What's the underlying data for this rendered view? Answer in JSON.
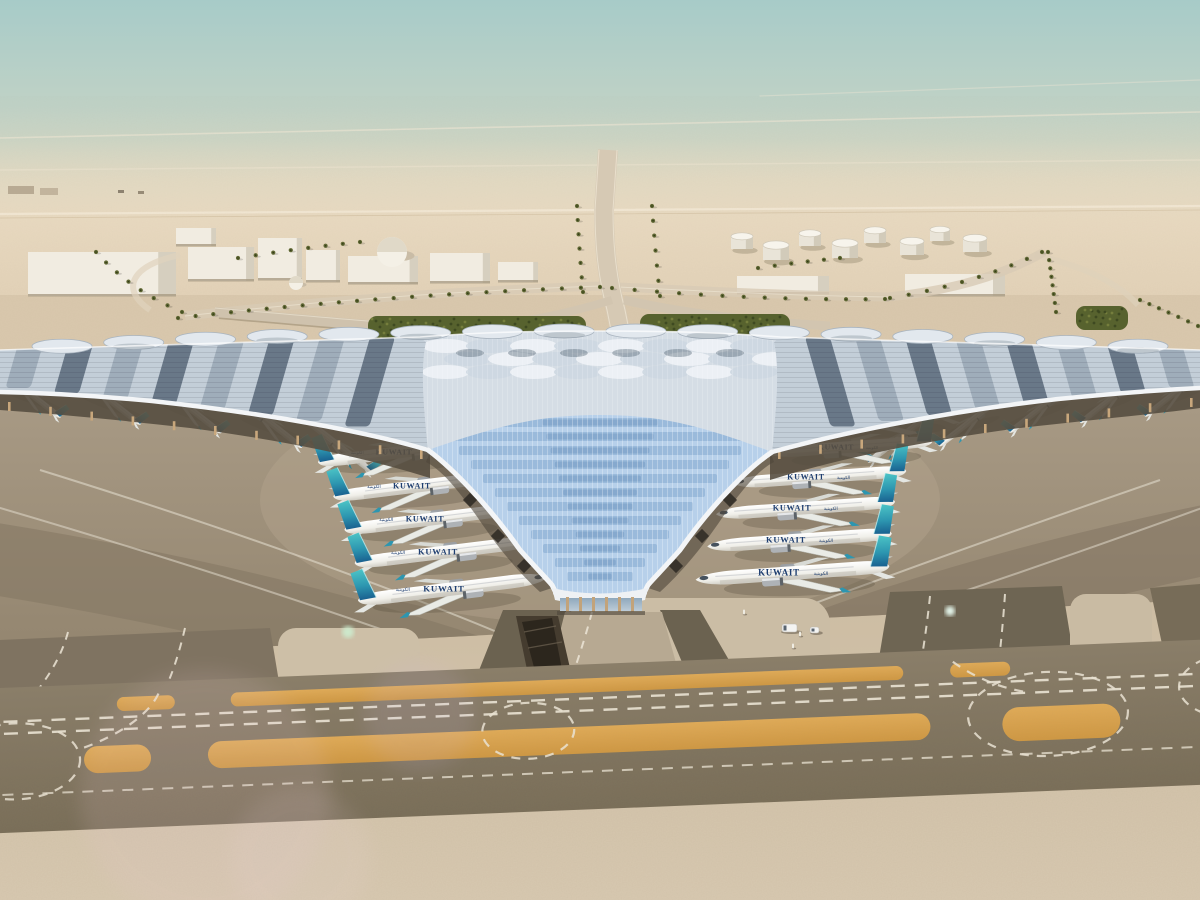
{
  "meta": {
    "description": "Aerial architectural rendering of a desert airport: trident-shaped terminal with blue photovoltaic roof, Kuwait Airways aircraft parked at gates, taxiways with sand-colored strips in foreground"
  },
  "airline": {
    "label": "KUWAIT",
    "arabic": "الكويتية",
    "title_color": "#1e3e70",
    "tail_top": "#4cc4c6",
    "tail_mid": "#2d96b0",
    "tail_base": "#19608f"
  },
  "palette": {
    "sky_top": "#a7cbc8",
    "sky_mid": "#c6d5c8",
    "haze": "#e5d9c3",
    "desert": "#e6d5bc",
    "midground_sand": "#d9c8ad",
    "apron": "#a3957f",
    "taxiway_dark": "#7f7360",
    "sand_strip_orange": "#d9a24e",
    "foreground_sand": "#d5c5ac",
    "roof_silver": "#d9e0e7",
    "roof_dark_panel": "#46586a",
    "valley_blue": "#b7d0ea",
    "hedge_green": "#57622e",
    "rim_white": "#f3f5f7",
    "column_tan": "#c8a77c",
    "marking_white": "#ece5d6"
  },
  "scene": {
    "plane_groups": [
      {
        "name": "outer-left-wing",
        "dir": -1,
        "rot": 38,
        "label": false,
        "planes": [
          [
            28,
            392,
            0.45
          ],
          [
            108,
            399,
            0.45
          ],
          [
            188,
            407,
            0.46
          ],
          [
            268,
            421,
            0.47
          ],
          [
            338,
            445,
            0.48
          ]
        ]
      },
      {
        "name": "outer-right-wing",
        "dir": 1,
        "rot": -38,
        "label": false,
        "planes": [
          [
            902,
            436,
            0.47
          ],
          [
            972,
            420,
            0.46
          ],
          [
            1042,
            407,
            0.45
          ],
          [
            1112,
            398,
            0.44
          ],
          [
            1176,
            392,
            0.43
          ]
        ]
      },
      {
        "name": "inner-left-concourse",
        "dir": 1,
        "rot": -7,
        "label": true,
        "planes": [
          [
            402,
            452,
            0.92
          ],
          [
            420,
            486,
            0.95
          ],
          [
            433,
            519,
            0.97
          ],
          [
            446,
            552,
            1.0
          ],
          [
            452,
            589,
            1.03
          ]
        ]
      },
      {
        "name": "inner-right-concourse",
        "dir": -1,
        "rot": -4,
        "label": true,
        "planes": [
          [
            878,
            419,
            0.85
          ],
          [
            850,
            447,
            0.9
          ],
          [
            820,
            477,
            0.94
          ],
          [
            806,
            508,
            0.97
          ],
          [
            800,
            540,
            1.0
          ],
          [
            793,
            573,
            1.05
          ]
        ]
      }
    ],
    "buildings": [
      {
        "x": 28,
        "y": 252,
        "w": 148,
        "h": 44
      },
      {
        "x": 188,
        "y": 247,
        "w": 66,
        "h": 34
      },
      {
        "x": 258,
        "y": 238,
        "w": 44,
        "h": 42
      },
      {
        "x": 306,
        "y": 250,
        "w": 34,
        "h": 32
      },
      {
        "x": 348,
        "y": 256,
        "w": 70,
        "h": 28
      },
      {
        "x": 430,
        "y": 253,
        "w": 60,
        "h": 30
      },
      {
        "x": 498,
        "y": 262,
        "w": 40,
        "h": 20
      },
      {
        "x": 905,
        "y": 274,
        "w": 100,
        "h": 22
      },
      {
        "x": 737,
        "y": 276,
        "w": 92,
        "h": 18
      },
      {
        "x": 176,
        "y": 228,
        "w": 40,
        "h": 18
      }
    ],
    "domes": [
      [
        392,
        252,
        15
      ],
      [
        296,
        283,
        7
      ]
    ],
    "fuel_tanks": [
      [
        742,
        249,
        11
      ],
      [
        810,
        246,
        11
      ],
      [
        875,
        243,
        11
      ],
      [
        940,
        241,
        10
      ],
      [
        776,
        260,
        13
      ],
      [
        845,
        258,
        13
      ],
      [
        912,
        255,
        12
      ],
      [
        975,
        252,
        12
      ]
    ],
    "palm_rows": [
      {
        "p0": [
          178,
          318
        ],
        "p1": [
          380,
          295
        ],
        "p2": [
          600,
          287
        ],
        "n": 24
      },
      {
        "p0": [
          612,
          288
        ],
        "p1": [
          760,
          301
        ],
        "p2": [
          885,
          299
        ],
        "n": 14
      },
      {
        "p0": [
          890,
          298
        ],
        "p1": [
          975,
          284
        ],
        "p2": [
          1042,
          252
        ],
        "n": 10
      },
      {
        "p0": [
          1048,
          252
        ],
        "p1": [
          1052,
          280
        ],
        "p2": [
          1056,
          312
        ],
        "n": 8
      },
      {
        "p0": [
          1140,
          300
        ],
        "p1": [
          1168,
          312
        ],
        "p2": [
          1198,
          326
        ],
        "n": 7
      },
      {
        "p0": [
          96,
          252
        ],
        "p1": [
          130,
          290
        ],
        "p2": [
          182,
          312
        ],
        "n": 8
      },
      {
        "p0": [
          577,
          206
        ],
        "p1": [
          579,
          248
        ],
        "p2": [
          583,
          292
        ],
        "n": 7
      },
      {
        "p0": [
          652,
          206
        ],
        "p1": [
          655,
          250
        ],
        "p2": [
          660,
          296
        ],
        "n": 7
      },
      {
        "p0": [
          238,
          258
        ],
        "p1": [
          300,
          248
        ],
        "p2": [
          360,
          242
        ],
        "n": 8
      },
      {
        "p0": [
          758,
          268
        ],
        "p1": [
          800,
          262
        ],
        "p2": [
          840,
          258
        ],
        "n": 6
      }
    ],
    "hedges": [
      {
        "x": 368,
        "y": 316,
        "w": 218,
        "h": 44
      },
      {
        "x": 640,
        "y": 314,
        "w": 150,
        "h": 42
      },
      {
        "x": 1076,
        "y": 306,
        "w": 52,
        "h": 24
      },
      {
        "x": 336,
        "y": 330,
        "w": 30,
        "h": 20
      }
    ],
    "strip1_segments": [
      [
        118,
        176
      ],
      [
        232,
        905
      ],
      [
        952,
        1012
      ]
    ],
    "strip2_segments": [
      [
        83,
        150
      ],
      [
        207,
        930
      ]
    ],
    "valley_rows": {
      "n": 12,
      "y0": 418,
      "step": 14,
      "w0": 330,
      "shrink": 24,
      "wmin": 54,
      "color": "#7da3cc"
    },
    "scallops": {
      "n": 16,
      "x0": 62,
      "x1": 1138
    },
    "facade_columns": {
      "n": 11
    },
    "wing_feathers": {
      "n": 8
    },
    "flares": [
      {
        "x": 348,
        "y": 632,
        "r": 6,
        "color": "#cdeccf",
        "op": 0.9
      },
      {
        "x": 950,
        "y": 611,
        "r": 5,
        "color": "#ecfff4",
        "op": 0.95
      },
      {
        "x": 205,
        "y": 795,
        "r": 125,
        "color": "#e8c8d2",
        "op": 0.13
      },
      {
        "x": 420,
        "y": 716,
        "r": 55,
        "color": "#cdb8e0",
        "op": 0.12
      },
      {
        "x": 300,
        "y": 858,
        "r": 70,
        "color": "#f0d8e2",
        "op": 0.1
      }
    ],
    "vehicles": [
      {
        "x": 782,
        "y": 624,
        "w": 15,
        "h": 8
      },
      {
        "x": 810,
        "y": 627,
        "w": 9,
        "h": 6
      }
    ],
    "cones": [
      [
        793,
        646
      ],
      [
        800,
        634
      ],
      [
        744,
        612
      ]
    ]
  }
}
